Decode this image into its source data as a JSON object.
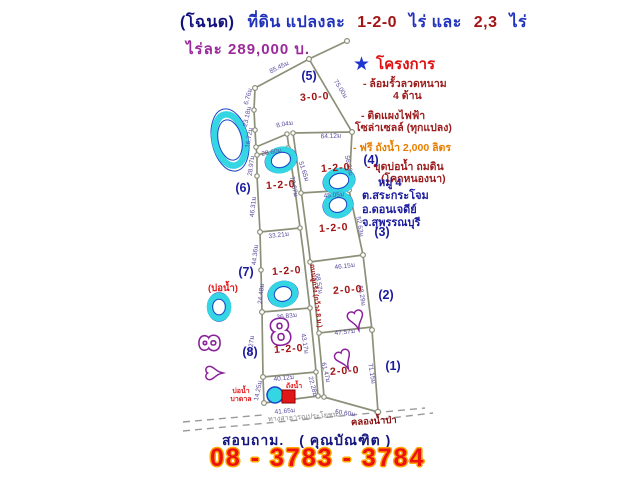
{
  "header": {
    "title": {
      "deed": "(โฉนด)",
      "land": "ที่ดิน  แปลงละ",
      "size1": "1-2-0",
      "rai1": "ไร่  และ",
      "size2": "2,3",
      "rai2": "ไร่"
    },
    "price": "ไร่ละ   289,000   บ."
  },
  "project": {
    "star_icon": "★",
    "title": "โครงการ",
    "bullets": [
      {
        "text": "- ล้อมรั้วลวดหนาม",
        "color": "#9b1c1c",
        "ml": 10,
        "mt": 2
      },
      {
        "text": "4 ด้าน",
        "color": "#9b1c1c",
        "ml": 40,
        "mt": 0
      },
      {
        "text": "- ติดแผงไฟฟ้า",
        "color": "#9b1c1c",
        "ml": 8,
        "mt": 7
      },
      {
        "text": "โซล่าเซลล์ (ทุกแปลง)",
        "color": "#9b1c1c",
        "ml": 2,
        "mt": 0
      },
      {
        "text": "- ฟรี ถังน้ำ 2,000 ลิตร",
        "color": "#e87f00",
        "ml": 0,
        "mt": 7
      },
      {
        "text": "- ขุดบ่อน้ำ ถมดิน",
        "color": "#9b1c1c",
        "ml": 14,
        "mt": 7
      },
      {
        "text": "(โคกหนองนา)",
        "color": "#9b1c1c",
        "ml": 28,
        "mt": 0
      }
    ],
    "address": [
      "หมู่ 4",
      "ต.สระกระโจม",
      "อ.ดอนเจดีย์",
      "จ.สุพรรณบุรี"
    ]
  },
  "contact": {
    "ask": "สอบถาม.",
    "name": "( คุณบัณฑิต )",
    "phone": "08 - 3783 - 3784"
  },
  "diagram": {
    "road_label": "ถนนลูกรัง (กว้าง 8 ม.)",
    "public_way_label": "ทางสาธารณประโยชน์",
    "canal_label": "คลองน้ำป่า",
    "well_note_outside": "(บ่อน้ำ)",
    "well_label_line1": "บ่อน้ำ",
    "well_label_line2": "บาดาล",
    "tank_label": "ถังน้ำ",
    "plots": [
      {
        "no": "(5)",
        "area": "3-0-0",
        "nx": 309,
        "ny": 80,
        "ax": 315,
        "ay": 100
      },
      {
        "no": "(6)",
        "area": "1-2-0",
        "nx": 243,
        "ny": 192,
        "ax": 281,
        "ay": 188
      },
      {
        "no": "(7)",
        "area": "1-2-0",
        "nx": 246,
        "ny": 276,
        "ax": 287,
        "ay": 274
      },
      {
        "no": "(8)",
        "area": "1-2-0",
        "nx": 250,
        "ny": 356,
        "ax": 289,
        "ay": 352
      },
      {
        "no": "(4)",
        "area": "1-2-0",
        "nx": 371,
        "ny": 164,
        "ax": 336,
        "ay": 171
      },
      {
        "no": "(3)",
        "area": "1-2-0",
        "nx": 382,
        "ny": 236,
        "ax": 334,
        "ay": 231
      },
      {
        "no": "(2)",
        "area": "2-0-0",
        "nx": 386,
        "ny": 299,
        "ax": 348,
        "ay": 293
      },
      {
        "no": "(1)",
        "area": "2-0-0",
        "nx": 393,
        "ny": 370,
        "ax": 345,
        "ay": 374
      }
    ],
    "dimensions": [
      {
        "t": "85.45ม",
        "x": 280,
        "y": 69,
        "r": -26
      },
      {
        "t": "75.00ม",
        "x": 339,
        "y": 90,
        "r": 58
      },
      {
        "t": "6.76ม",
        "x": 250,
        "y": 97,
        "r": -75
      },
      {
        "t": "23.18ม",
        "x": 249,
        "y": 117,
        "r": -78
      },
      {
        "t": "16.72ม",
        "x": 251,
        "y": 138,
        "r": -80
      },
      {
        "t": "8.04ม",
        "x": 285,
        "y": 126,
        "r": -10
      },
      {
        "t": "64.12ม",
        "x": 331,
        "y": 138,
        "r": -2
      },
      {
        "t": "28.60ม",
        "x": 272,
        "y": 154,
        "r": -10
      },
      {
        "t": "28.97ม",
        "x": 253,
        "y": 166,
        "r": -82
      },
      {
        "t": "51.65ม",
        "x": 302,
        "y": 172,
        "r": 72
      },
      {
        "t": "56.23ม",
        "x": 347,
        "y": 166,
        "r": 78
      },
      {
        "t": "78.67ม",
        "x": 292,
        "y": 187,
        "r": 78
      },
      {
        "t": "45.05ม",
        "x": 334,
        "y": 197,
        "r": -4
      },
      {
        "t": "46.31ม",
        "x": 255,
        "y": 207,
        "r": -84
      },
      {
        "t": "52.63ม",
        "x": 358,
        "y": 227,
        "r": 80
      },
      {
        "t": "33.21ม",
        "x": 279,
        "y": 237,
        "r": -7
      },
      {
        "t": "44.36ม",
        "x": 257,
        "y": 255,
        "r": -84
      },
      {
        "t": "46.15ม",
        "x": 345,
        "y": 268,
        "r": -7
      },
      {
        "t": "68.57ม",
        "x": 317,
        "y": 284,
        "r": 80
      },
      {
        "t": "68.29ม",
        "x": 360,
        "y": 296,
        "r": 80
      },
      {
        "t": "24.48ม",
        "x": 263,
        "y": 294,
        "r": -84
      },
      {
        "t": "36.83ม",
        "x": 287,
        "y": 318,
        "r": -7
      },
      {
        "t": "47.57ม",
        "x": 345,
        "y": 334,
        "r": -6
      },
      {
        "t": "43.27ม",
        "x": 253,
        "y": 346,
        "r": -84
      },
      {
        "t": "43.17ม",
        "x": 303,
        "y": 344,
        "r": 80
      },
      {
        "t": "61.47ม",
        "x": 324,
        "y": 373,
        "r": 76
      },
      {
        "t": "40.12ม",
        "x": 284,
        "y": 380,
        "r": -6
      },
      {
        "t": "14.25ม",
        "x": 260,
        "y": 391,
        "r": -78
      },
      {
        "t": "22.28ม",
        "x": 311,
        "y": 387,
        "r": 76
      },
      {
        "t": "71.15ม",
        "x": 370,
        "y": 374,
        "r": 80
      },
      {
        "t": "41.65ม",
        "x": 285,
        "y": 413,
        "r": -5
      },
      {
        "t": "50.60ม",
        "x": 345,
        "y": 415,
        "r": 8
      }
    ],
    "watermarks": {
      "rings": [
        {
          "cx": 230,
          "cy": 140,
          "rx": 15,
          "ry": 26,
          "r": -12
        },
        {
          "cx": 281,
          "cy": 160,
          "rx": 13,
          "ry": 10,
          "r": -18
        },
        {
          "cx": 339,
          "cy": 181,
          "rx": 13,
          "ry": 10,
          "r": -15
        },
        {
          "cx": 338,
          "cy": 205,
          "rx": 12,
          "ry": 10,
          "r": -15
        },
        {
          "cx": 283,
          "cy": 294,
          "rx": 12,
          "ry": 10,
          "r": -15
        },
        {
          "cx": 219,
          "cy": 307,
          "rx": 11,
          "ry": 9,
          "r": -90
        }
      ],
      "eights": [
        {
          "g": "8",
          "x": 282,
          "y": 344,
          "s": 36,
          "r": -8
        },
        {
          "g": "8",
          "x": 219,
          "y": 343,
          "s": 28,
          "r": -90
        }
      ],
      "hearts": [
        {
          "g": "♥",
          "x": 358,
          "y": 327,
          "s": 28,
          "r": -15
        },
        {
          "g": "♥",
          "x": 347,
          "y": 366,
          "s": 28,
          "r": -25
        },
        {
          "g": "♥",
          "x": 220,
          "y": 373,
          "s": 24,
          "r": -90
        }
      ]
    },
    "colors": {
      "line": "#8b9078",
      "dim_text": "#5a4a9a",
      "plot_no": "#1b1b9e",
      "plot_area": "#a21515",
      "cyan": "#35d6e4",
      "cyan_edge": "#1b43c8",
      "magenta": "#8a1f9b",
      "red": "#e01818"
    }
  }
}
